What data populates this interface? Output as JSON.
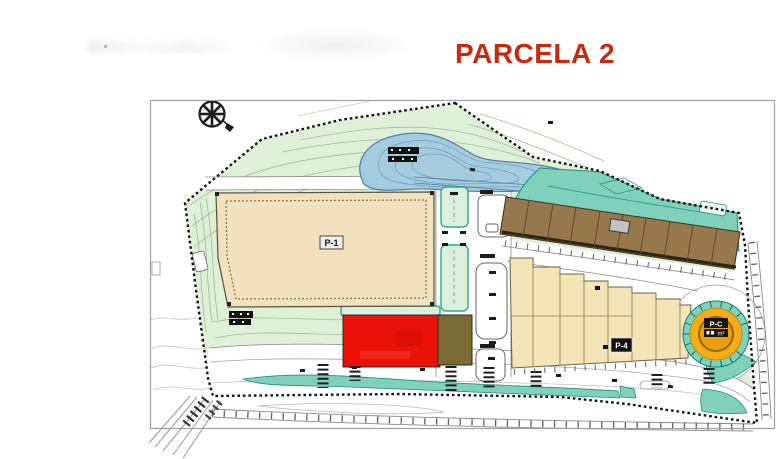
{
  "title": {
    "text": "PARCELA 2"
  },
  "plan": {
    "building_labels": {
      "p1": "P-1",
      "p4": "P-4",
      "pc": "P-C",
      "pc_area_unit": "m²"
    }
  },
  "colors": {
    "title_red": "#c92a0e",
    "frame_border": "#a0a0a0",
    "site_green": "#def0d8",
    "contour_green": "#96b892",
    "pond_fill": "#a5cbdf",
    "pond_line": "#4f7fa5",
    "teal_fill": "#7fd1bc",
    "teal_line": "#1f8f77",
    "teal_strip_fill": "#daf0dc",
    "teal_strip_border": "#2da88d",
    "p1_fill": "#f1e1bf",
    "p1_border": "#5b5340",
    "red_fill": "#ea1208",
    "olive_fill": "#7a6a33",
    "brown_fill": "#97784c",
    "brown_line": "#5a4628",
    "cream_fill": "#f3e5b8",
    "cream_line": "#8a7a50",
    "circle_orange": "#f6ac17",
    "circle_orange_inner": "#eb9d0e",
    "road_gray": "#8a8a8a",
    "ink": "#141414"
  }
}
